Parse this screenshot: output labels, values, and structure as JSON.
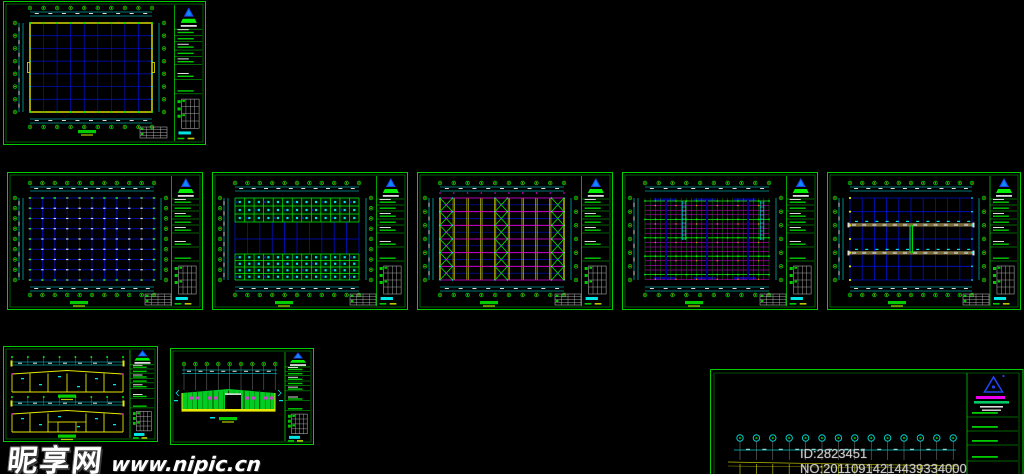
{
  "watermarks": {
    "site_name": "昵享网",
    "site_url": "www.nipic.cn",
    "id_text": "ID:2823451 NO:20110914214439334000"
  },
  "palette": {
    "background": "#000000",
    "frame_green": "#00cc00",
    "inner_green": "#009900",
    "grid_blue": "#0011cc",
    "dim_cyan": "#00e5e5",
    "yellow": "#e8e800",
    "magenta": "#ee00ee",
    "white": "#dddddd",
    "olive": "#7c6c38",
    "orange": "#ff8800",
    "dark_blue": "#000099",
    "bright_green": "#00ee00",
    "logo_blue": "#2244ee",
    "bubble_dot": "#b8cc00"
  },
  "sheets": [
    {
      "id": "sheet-1",
      "name": "foundation-plan",
      "x": 3,
      "y": 1,
      "w": 203,
      "h": 144,
      "type": "planYellow"
    },
    {
      "id": "sheet-2",
      "name": "column-grid-plan",
      "x": 7,
      "y": 172,
      "w": 196,
      "h": 138,
      "type": "planPlain"
    },
    {
      "id": "sheet-3",
      "name": "roof-framing-bands-plan",
      "x": 212,
      "y": 172,
      "w": 196,
      "h": 138,
      "type": "planBands"
    },
    {
      "id": "sheet-4",
      "name": "bracing-plan",
      "x": 417,
      "y": 172,
      "w": 196,
      "h": 138,
      "type": "planBracing"
    },
    {
      "id": "sheet-5",
      "name": "purlin-layout-plan",
      "x": 622,
      "y": 172,
      "w": 196,
      "h": 138,
      "type": "planPurlins"
    },
    {
      "id": "sheet-6",
      "name": "tie-beam-plan",
      "x": 827,
      "y": 172,
      "w": 194,
      "h": 138,
      "type": "planTwoBands"
    },
    {
      "id": "sheet-7",
      "name": "portal-frame-elevations",
      "x": 3,
      "y": 346,
      "w": 155,
      "h": 96,
      "type": "elevFrames"
    },
    {
      "id": "sheet-8",
      "name": "wall-elevation",
      "x": 170,
      "y": 348,
      "w": 144,
      "h": 97,
      "type": "elevWall"
    },
    {
      "id": "sheet-9",
      "name": "section-partial",
      "x": 710,
      "y": 369,
      "w": 314,
      "h": 105,
      "type": "partialSection"
    }
  ]
}
